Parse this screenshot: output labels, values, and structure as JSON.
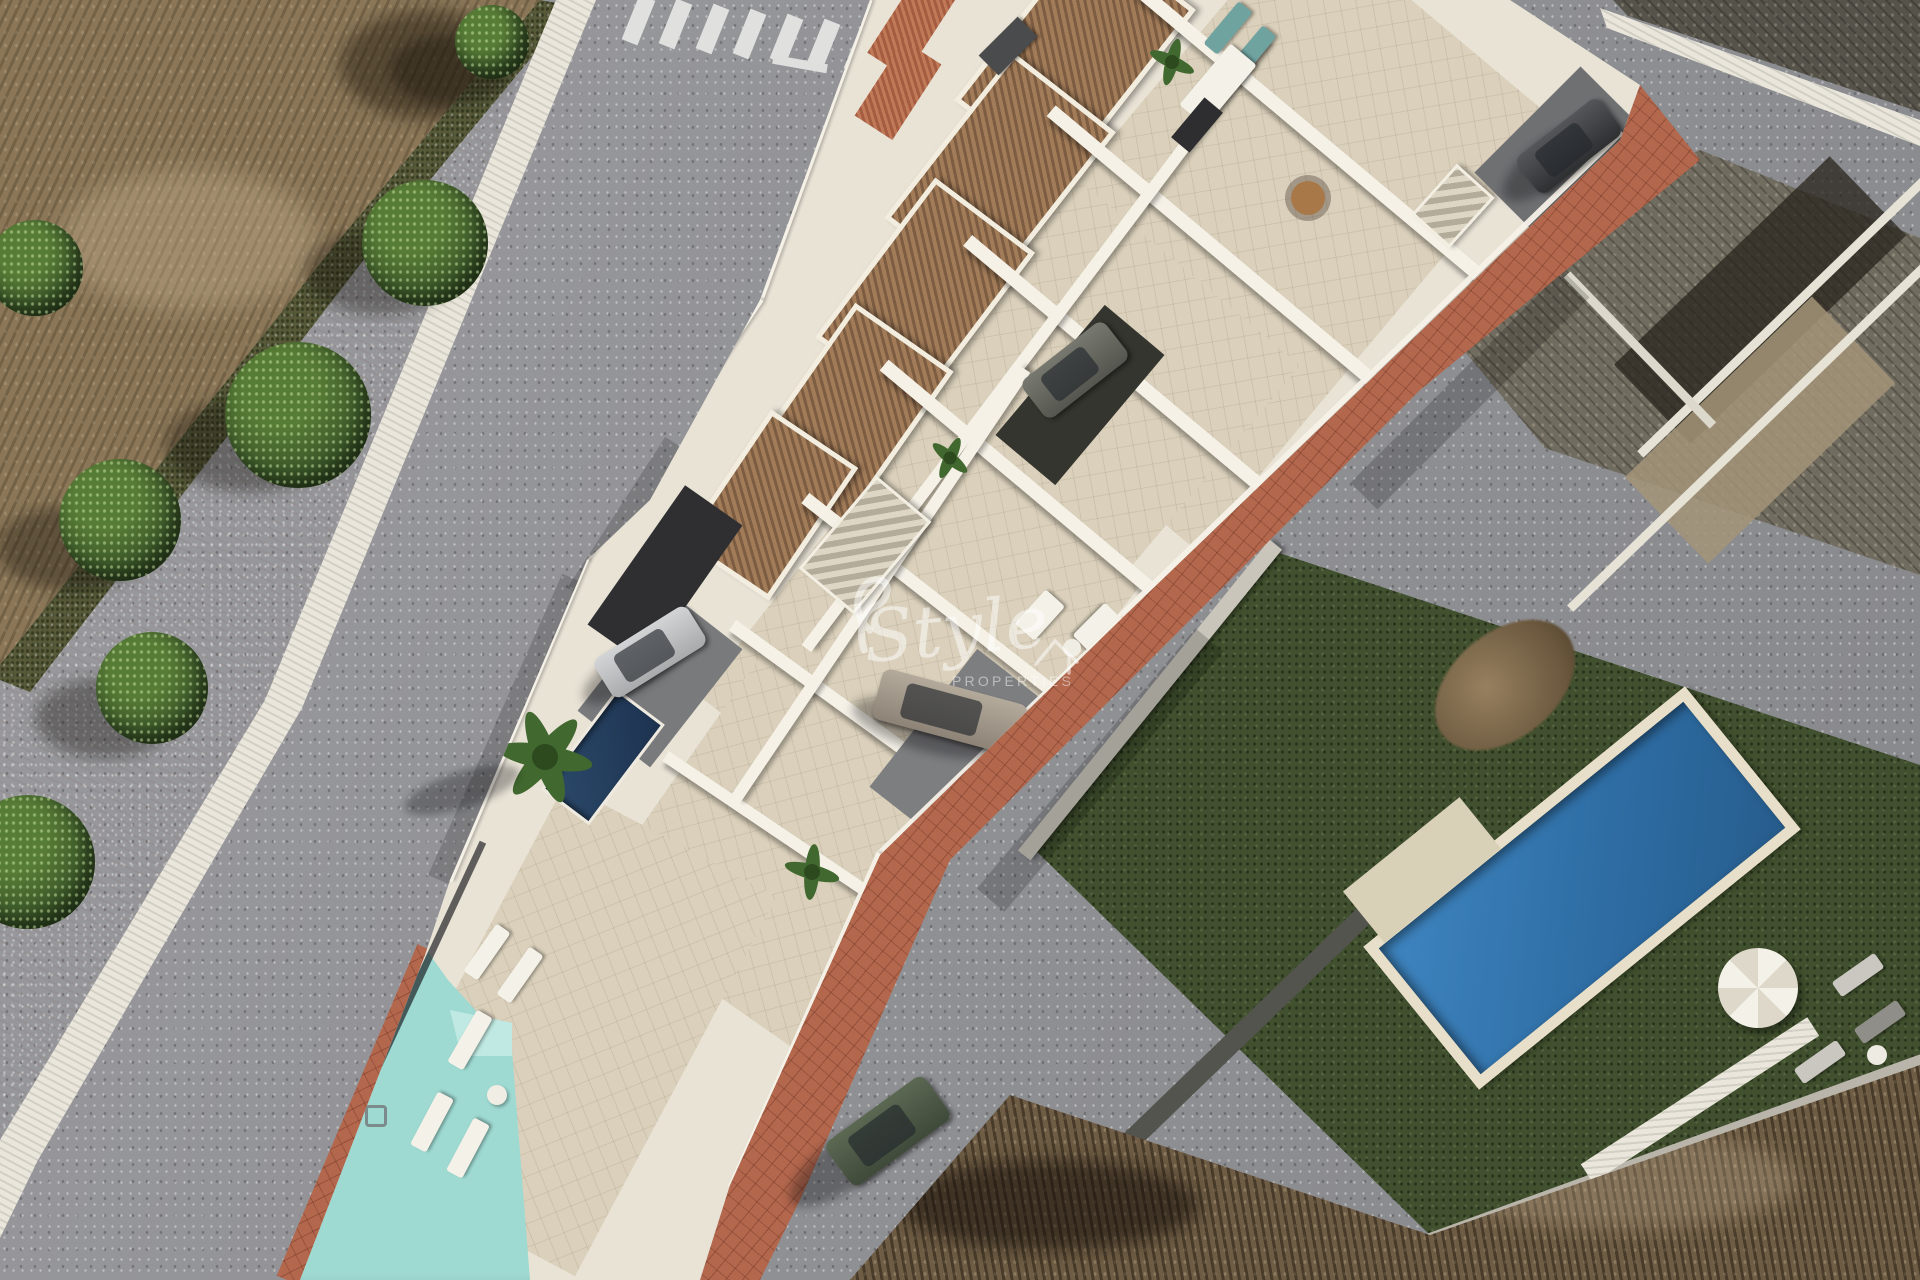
{
  "image": {
    "kind": "aerial-3d-architectural-render",
    "subject": "New-build white townhouse development with roof terraces and pools beside existing villas and dirt plots",
    "width_px": 1920,
    "height_px": 1280
  },
  "watermark": {
    "brand_script": "Style",
    "brand_caps": "PROPERTIES",
    "icon": "house-outline-icon",
    "color": "#ffffff"
  },
  "palette": {
    "asphalt": "#96969a",
    "dirt_top_left": "#8b7758",
    "dirt_bottom_right": "#6e5c44",
    "sidewalk_pink": "#d9a496",
    "curb_white": "#eae6db",
    "development_white": "#e9e3d6",
    "terrace_beige": "#dad0bb",
    "pergola_wood": "#8d6c4d",
    "brick_sidewalk": "#b3674d",
    "communal_pool_aqua": "#9edad2",
    "plunge_pool_navy": "#24405e",
    "villa_grass_green": "#41502e",
    "villa_pool_blue": "#2e6da4",
    "pool_deck_cream": "#e7dfc9",
    "old_roof_gray": "#716c60",
    "tree_green": "#3d5a2a",
    "car_silver": "#b9babc",
    "car_greige": "#998f82",
    "car_dark": "#3b3c3e",
    "pickup_green": "#4d5a46",
    "teal_lounger": "#6fa3a0"
  },
  "scene_objects": [
    "dry-field-top-left",
    "pink-sidewalk-with-trees",
    "white-curb",
    "asphalt-street-left",
    "zebra-crosswalk",
    "townhouse-development-wedge",
    "tiled-roof-edges",
    "wood-pergola-roof-terraces",
    "roof-terrace-furniture",
    "staircases",
    "plunge-pool",
    "palm-trees",
    "parked-cars",
    "communal-pool",
    "sun-loungers",
    "terracotta-brick-sidewalk",
    "asphalt-street-right",
    "old-flat-roof-building",
    "neighbor-villa-garden",
    "villa-blue-pool",
    "white-parasol",
    "dry-field-bottom-right",
    "watermark-style-properties"
  ]
}
